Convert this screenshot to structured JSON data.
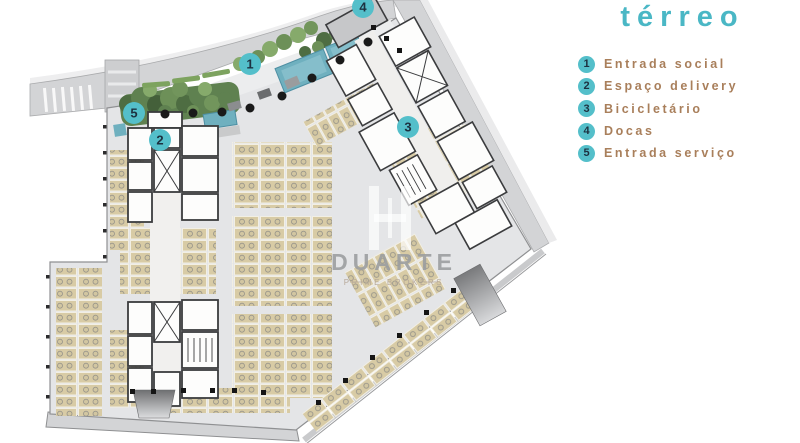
{
  "title": "térreo",
  "colors": {
    "accent_teal": "#4ab7c5",
    "marker_fill": "#54bfca",
    "marker_number": "#1d3140",
    "legend_text_brown": "#a97f5b",
    "parking_stall_tan": "#d8cba5",
    "water_teal": "#6fb0bf",
    "landscape_green": "#5f8150"
  },
  "legend": {
    "items": [
      {
        "number": "1",
        "label": "Entrada social"
      },
      {
        "number": "2",
        "label": "Espaço delivery"
      },
      {
        "number": "3",
        "label": "Bicicletário"
      },
      {
        "number": "4",
        "label": "Docas"
      },
      {
        "number": "5",
        "label": "Entrada serviço"
      }
    ]
  },
  "watermark": {
    "name": "DUARTE",
    "tagline": "PRIME BROKERS"
  }
}
